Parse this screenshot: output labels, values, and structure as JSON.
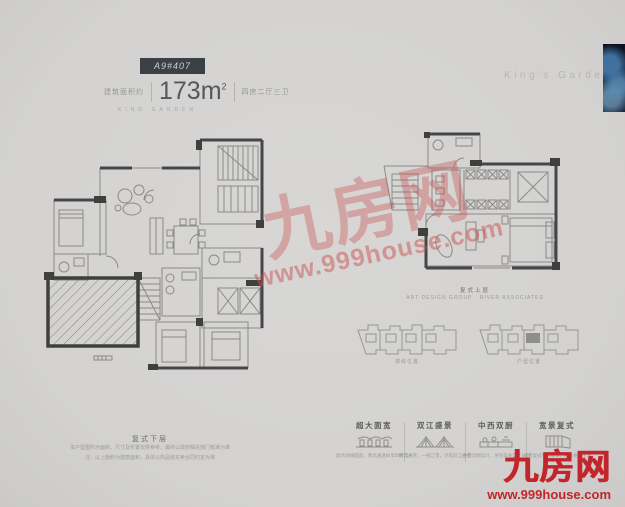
{
  "page": {
    "background": "#d5d4d2",
    "accent_red": "#c2262b",
    "watermark_pink": "#c95252"
  },
  "header": {
    "unit_badge": "A9#407",
    "area_label": "建筑面积约",
    "area_value": "173m",
    "area_sup": "2",
    "rooms_label": "四房二厅三卫",
    "subtitle": "KING GARDEN"
  },
  "brand": {
    "name_en": "King's Garden",
    "logo": "九房网",
    "site": "www.999house.com"
  },
  "watermark": {
    "logo": "九房网",
    "site": "www.999house.com"
  },
  "captions": {
    "lower": {
      "title": "复式下层",
      "line1": "本户型图所示面积、尺寸及布置仅供参考，最终以政府相关部门核准为准",
      "line2": "注：以上面积为建筑面积，具体以商品房买卖合同约定为准"
    },
    "upper": {
      "title": "复式上层",
      "line": "ART DESIGN GROUP · RIVER ASSOCIATES"
    },
    "keyplan_left": "楼栋位置",
    "keyplan_right": "户型位置"
  },
  "features": [
    {
      "title": "超大面宽",
      "desc": "超大阔绰面宽，南北通透纵享四时风光",
      "icon": "facade-icon"
    },
    {
      "title": "双江盛景",
      "desc": "瞰江大宅，一线江景，尽揽双江盛景",
      "icon": "bridge-icon"
    },
    {
      "title": "中西双厨",
      "desc": "中西双厨设计，烹饪美食自在从容",
      "icon": "kitchen-icon"
    },
    {
      "title": "宽景复式",
      "desc": "宽景复式空间尊享，品质格调生活",
      "icon": "duplex-icon"
    }
  ]
}
